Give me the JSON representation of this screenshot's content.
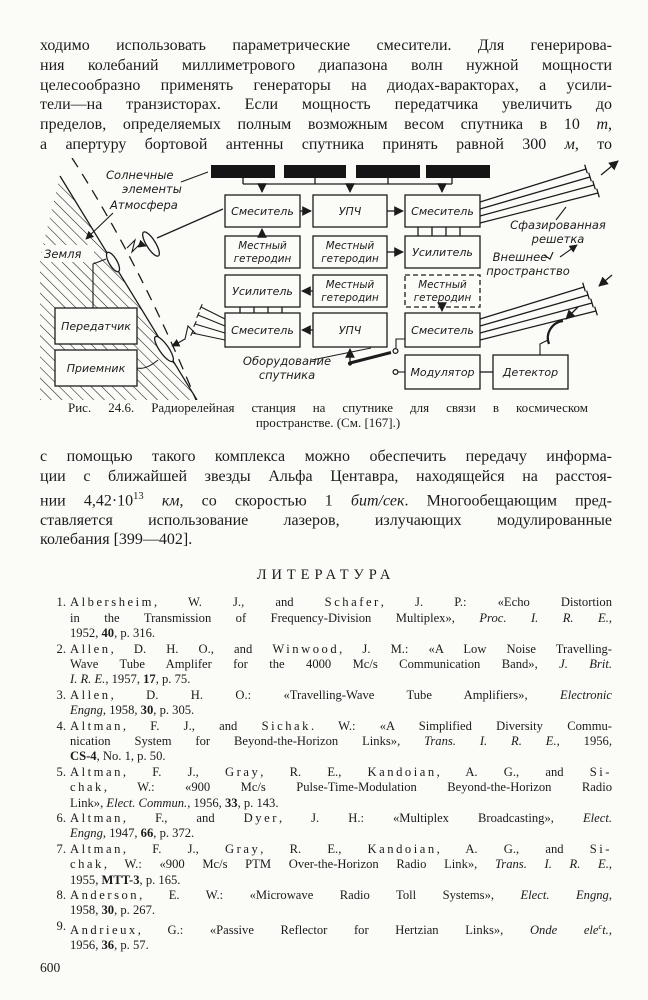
{
  "para1": {
    "lines": [
      [
        {
          "t": "ходимо использовать параметрические смесители. Для генерирова-"
        }
      ],
      [
        {
          "t": "ния колебаний миллиметрового диапазона волн нужной мощности"
        }
      ],
      [
        {
          "t": "целесообразно применять генераторы на диодах-варакторах, а усили-"
        }
      ],
      [
        {
          "t": "тели—на транзисторах. Если мощность передатчика увеличить до"
        }
      ],
      [
        {
          "t": "пределов, определяемых полным возможным весом спутника в 10 "
        },
        {
          "t": "т",
          "i": 1
        },
        {
          "t": ","
        }
      ],
      [
        {
          "t": "а апертуру бортовой антенны спутника принять равной 300 "
        },
        {
          "t": "м",
          "i": 1
        },
        {
          "t": ", то"
        }
      ]
    ]
  },
  "diagram": {
    "solar_label": [
      "Солнечные",
      "элементы"
    ],
    "atmosphere_label": "Атмосфера",
    "earth_label": "Земля",
    "transmitter": "Передатчик",
    "receiver": "Приемник",
    "equipment_label": [
      "Оборудование",
      "спутника"
    ],
    "phased_array_label": [
      "Сфазированная",
      "решетка"
    ],
    "outer_space_label": [
      "Внешнее",
      "пространство"
    ],
    "mixer": "Смеситель",
    "if_amplifier": "УПЧ",
    "local_oscillator": [
      "Местный",
      "гетеродин"
    ],
    "amplifier": "Усилитель",
    "modulator": "Модулятор",
    "detector": "Детектор"
  },
  "caption": {
    "line1": "Рис. 24.6. Радиорелейная станция на спутнике для связи в космическом",
    "line2": "пространстве. (См. [167].)"
  },
  "para2": {
    "lines": [
      [
        {
          "t": "с помощью такого комплекса можно обеспечить передачу информа-"
        }
      ],
      [
        {
          "t": "ции с ближайшей звезды Альфа Центавра, находящейся на расстоя-"
        }
      ],
      [
        {
          "t": "нии 4,42·10"
        },
        {
          "t": "13",
          "sup": 1
        },
        {
          "t": " "
        },
        {
          "t": "км",
          "i": 1
        },
        {
          "t": ", со скоростью 1 "
        },
        {
          "t": "бит/сек",
          "i": 1
        },
        {
          "t": ". Многообещающим пред-"
        }
      ],
      [
        {
          "t": "ставляется использование лазеров, излучающих модулированные"
        }
      ],
      [
        {
          "t": "колебания [399—402]."
        }
      ]
    ]
  },
  "references": {
    "heading": "ЛИТЕРАТУРА",
    "items": [
      {
        "num": "1.",
        "lines": [
          [
            {
              "t": "Albersheim",
              "sp": 1
            },
            {
              "t": ", W. J., and "
            },
            {
              "t": "Schafer",
              "sp": 1
            },
            {
              "t": ", J. P.: «Echo Distortion"
            }
          ],
          [
            {
              "t": "in the Transmission of Frequency-Division Multiplex», "
            },
            {
              "t": "Proc. I. R. E.",
              "i": 1
            },
            {
              "t": ","
            }
          ],
          [
            {
              "t": "1952, "
            },
            {
              "t": "40",
              "b": 1
            },
            {
              "t": ", p. 316."
            }
          ]
        ]
      },
      {
        "num": "2.",
        "lines": [
          [
            {
              "t": "Allen",
              "sp": 1
            },
            {
              "t": ", D. H. O., and "
            },
            {
              "t": "Winwood",
              "sp": 1
            },
            {
              "t": ", J. M.: «A Low Noise Travelling-"
            }
          ],
          [
            {
              "t": "Wave Tube Amplifer for the 4000 Mc/s Communication Band», "
            },
            {
              "t": "J. Brit.",
              "i": 1
            }
          ],
          [
            {
              "t": "I. R. E.",
              "i": 1
            },
            {
              "t": ", 1957, "
            },
            {
              "t": "17",
              "b": 1
            },
            {
              "t": ", p. 75."
            }
          ]
        ]
      },
      {
        "num": "3.",
        "lines": [
          [
            {
              "t": "Allen",
              "sp": 1
            },
            {
              "t": ", D. H. O.: «Travelling-Wave Tube Amplifiers», "
            },
            {
              "t": "Electronic",
              "i": 1
            }
          ],
          [
            {
              "t": "Engng",
              "i": 1
            },
            {
              "t": ", 1958, "
            },
            {
              "t": "30",
              "b": 1
            },
            {
              "t": ", p. 305."
            }
          ]
        ]
      },
      {
        "num": "4.",
        "lines": [
          [
            {
              "t": "Altman",
              "sp": 1
            },
            {
              "t": ", F. J., and "
            },
            {
              "t": "Sichak",
              "sp": 1
            },
            {
              "t": ". W.: «A Simplified Diversity Commu-"
            }
          ],
          [
            {
              "t": "nication System for Beyond-the-Horizon Links», "
            },
            {
              "t": "Trans. I. R. E.",
              "i": 1
            },
            {
              "t": ", 1956,"
            }
          ],
          [
            {
              "t": "CS-4",
              "b": 1
            },
            {
              "t": ", No. 1, p. 50."
            }
          ]
        ]
      },
      {
        "num": "5.",
        "lines": [
          [
            {
              "t": "Altman",
              "sp": 1
            },
            {
              "t": ", F. J., "
            },
            {
              "t": "Gray",
              "sp": 1
            },
            {
              "t": ", R. E., "
            },
            {
              "t": "Kandoian",
              "sp": 1
            },
            {
              "t": ", A. G., and "
            },
            {
              "t": "Si-",
              "sp": 1
            }
          ],
          [
            {
              "t": "chak",
              "sp": 1
            },
            {
              "t": ", W.: «900 Mc/s Pulse-Time-Modulation Beyond-the-Horizon Radio"
            }
          ],
          [
            {
              "t": "Link», "
            },
            {
              "t": "Elect. Commun.",
              "i": 1
            },
            {
              "t": ", 1956, "
            },
            {
              "t": "33",
              "b": 1
            },
            {
              "t": ", p. 143."
            }
          ]
        ]
      },
      {
        "num": "6.",
        "lines": [
          [
            {
              "t": "Altman",
              "sp": 1
            },
            {
              "t": ", F., and "
            },
            {
              "t": "Dyer",
              "sp": 1
            },
            {
              "t": ", J. H.: «Multiplex Broadcasting», "
            },
            {
              "t": "Elect.",
              "i": 1
            }
          ],
          [
            {
              "t": "Engng",
              "i": 1
            },
            {
              "t": ", 1947, "
            },
            {
              "t": "66",
              "b": 1
            },
            {
              "t": ", p. 372."
            }
          ]
        ]
      },
      {
        "num": "7.",
        "lines": [
          [
            {
              "t": "Altman",
              "sp": 1
            },
            {
              "t": ", F. J., "
            },
            {
              "t": "Gray",
              "sp": 1
            },
            {
              "t": ", R. E., "
            },
            {
              "t": "Kandoian",
              "sp": 1
            },
            {
              "t": ", A. G., and "
            },
            {
              "t": "Si-",
              "sp": 1
            }
          ],
          [
            {
              "t": "chak",
              "sp": 1
            },
            {
              "t": ", W.: «900 Mc/s PTM Over-the-Horizon Radio Link», "
            },
            {
              "t": "Trans. I. R. E.",
              "i": 1
            },
            {
              "t": ","
            }
          ],
          [
            {
              "t": "1955, "
            },
            {
              "t": "MTT-3",
              "b": 1
            },
            {
              "t": ", p. 165."
            }
          ]
        ]
      },
      {
        "num": "8.",
        "lines": [
          [
            {
              "t": "Anderson",
              "sp": 1
            },
            {
              "t": ", E. W.: «Microwave Radio Toll Systems», "
            },
            {
              "t": "Elect. Engng",
              "i": 1
            },
            {
              "t": ","
            }
          ],
          [
            {
              "t": "1958, "
            },
            {
              "t": "30",
              "b": 1
            },
            {
              "t": ", p. 267."
            }
          ]
        ]
      },
      {
        "num": "9.",
        "lines": [
          [
            {
              "t": "Andrieux",
              "sp": 1
            },
            {
              "t": ", G.: «Passive Reflector for Hertzian Links», "
            },
            {
              "t": "Onde ele",
              "i": 1
            },
            {
              "t": "c",
              "i": 1,
              "sup": 1
            },
            {
              "t": "t.",
              "i": 1
            },
            {
              "t": ","
            }
          ],
          [
            {
              "t": "1956, "
            },
            {
              "t": "36",
              "b": 1
            },
            {
              "t": ", p. 57."
            }
          ]
        ]
      }
    ]
  },
  "page": {
    "number": "600"
  }
}
